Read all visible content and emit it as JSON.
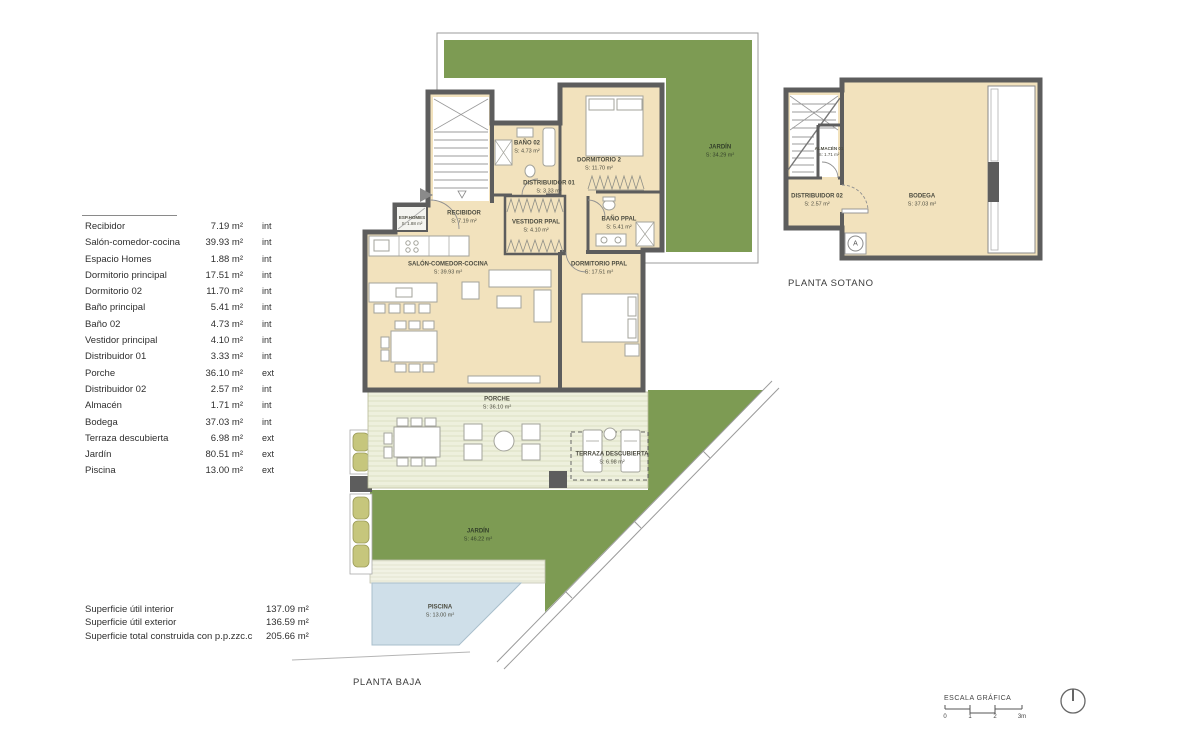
{
  "colors": {
    "room_fill": "#f2e2bd",
    "garden_green": "#7d9b53",
    "wall": "#5d5d5d",
    "porch": "#eef0dd",
    "pool": "#cfdfe9",
    "planter": "#c6c67c"
  },
  "legend": {
    "rows": [
      {
        "name": "Recibidor",
        "area": "7.19 m²",
        "type": "int"
      },
      {
        "name": "Salón-comedor-cocina",
        "area": "39.93 m²",
        "type": "int"
      },
      {
        "name": "Espacio Homes",
        "area": "1.88 m²",
        "type": "int"
      },
      {
        "name": "Dormitorio principal",
        "area": "17.51 m²",
        "type": "int"
      },
      {
        "name": "Dormitorio 02",
        "area": "11.70 m²",
        "type": "int"
      },
      {
        "name": "Baño principal",
        "area": "5.41 m²",
        "type": "int"
      },
      {
        "name": "Baño 02",
        "area": "4.73 m²",
        "type": "int"
      },
      {
        "name": "Vestidor principal",
        "area": "4.10 m²",
        "type": "int"
      },
      {
        "name": "Distribuidor 01",
        "area": "3.33 m²",
        "type": "int"
      },
      {
        "name": "Porche",
        "area": "36.10 m²",
        "type": "ext"
      },
      {
        "name": "Distribuidor 02",
        "area": "2.57 m²",
        "type": "int"
      },
      {
        "name": "Almacén",
        "area": "1.71 m²",
        "type": "int"
      },
      {
        "name": "Bodega",
        "area": "37.03 m²",
        "type": "int"
      },
      {
        "name": "Terraza descubierta",
        "area": "6.98 m²",
        "type": "ext"
      },
      {
        "name": "Jardín",
        "area": "80.51 m²",
        "type": "ext"
      },
      {
        "name": "Piscina",
        "area": "13.00 m²",
        "type": "ext"
      }
    ]
  },
  "totals": {
    "rows": [
      {
        "name": "Superficie útil interior",
        "value": "137.09 m²"
      },
      {
        "name": "Superficie útil exterior",
        "value": "136.59 m²"
      },
      {
        "name": "Superficie total construida con p.p.zzc.c",
        "value": "205.66 m²"
      }
    ]
  },
  "plan_baja": {
    "title": "PLANTA BAJA",
    "rooms": {
      "jardin_superior": {
        "name": "JARDÍN",
        "area": "S: 34.29 m²"
      },
      "bano02": {
        "name": "BAÑO 02",
        "area": "S: 4.73 m²"
      },
      "dormitorio2": {
        "name": "DORMITORIO 2",
        "area": "S: 11.70 m²"
      },
      "distribuidor01": {
        "name": "DISTRIBUIDOR 01",
        "area": "S: 3.33 m²"
      },
      "recibidor": {
        "name": "RECIBIDOR",
        "area": "S: 7.19 m²"
      },
      "esp_homes": {
        "name": "ESP.HOMES",
        "area": "S: 1.88 m²"
      },
      "vestidor": {
        "name": "VESTIDOR PPAL",
        "area": "S: 4.10 m²"
      },
      "bano_ppal": {
        "name": "BAÑO PPAL",
        "area": "S: 5.41 m²"
      },
      "salon": {
        "name": "SALÓN-COMEDOR-COCINA",
        "area": "S: 39.93 m²"
      },
      "dormitorio_ppal": {
        "name": "DORMITORIO PPAL",
        "area": "S: 17.51 m²"
      },
      "porche": {
        "name": "PORCHE",
        "area": "S: 36.10 m²"
      },
      "terraza": {
        "name": "TERRAZA DESCUBIERTA",
        "area": "S: 6.98 m²"
      },
      "jardin": {
        "name": "JARDÍN",
        "area": "S: 46.22 m²"
      },
      "piscina": {
        "name": "PISCINA",
        "area": "S: 13.00 m²"
      }
    }
  },
  "plan_sotano": {
    "title": "PLANTA SOTANO",
    "marker": "A",
    "rooms": {
      "almacen": {
        "name": "ALMACÉN 01",
        "area": "S: 1.71 m²"
      },
      "distribuidor02": {
        "name": "DISTRIBUIDOR 02",
        "area": "S: 2.57 m²"
      },
      "bodega": {
        "name": "BODEGA",
        "area": "S: 37.03 m²"
      }
    }
  },
  "scale_bar": {
    "title": "ESCALA GRÁFICA",
    "ticks": [
      "0",
      "1",
      "2",
      "3m"
    ]
  }
}
